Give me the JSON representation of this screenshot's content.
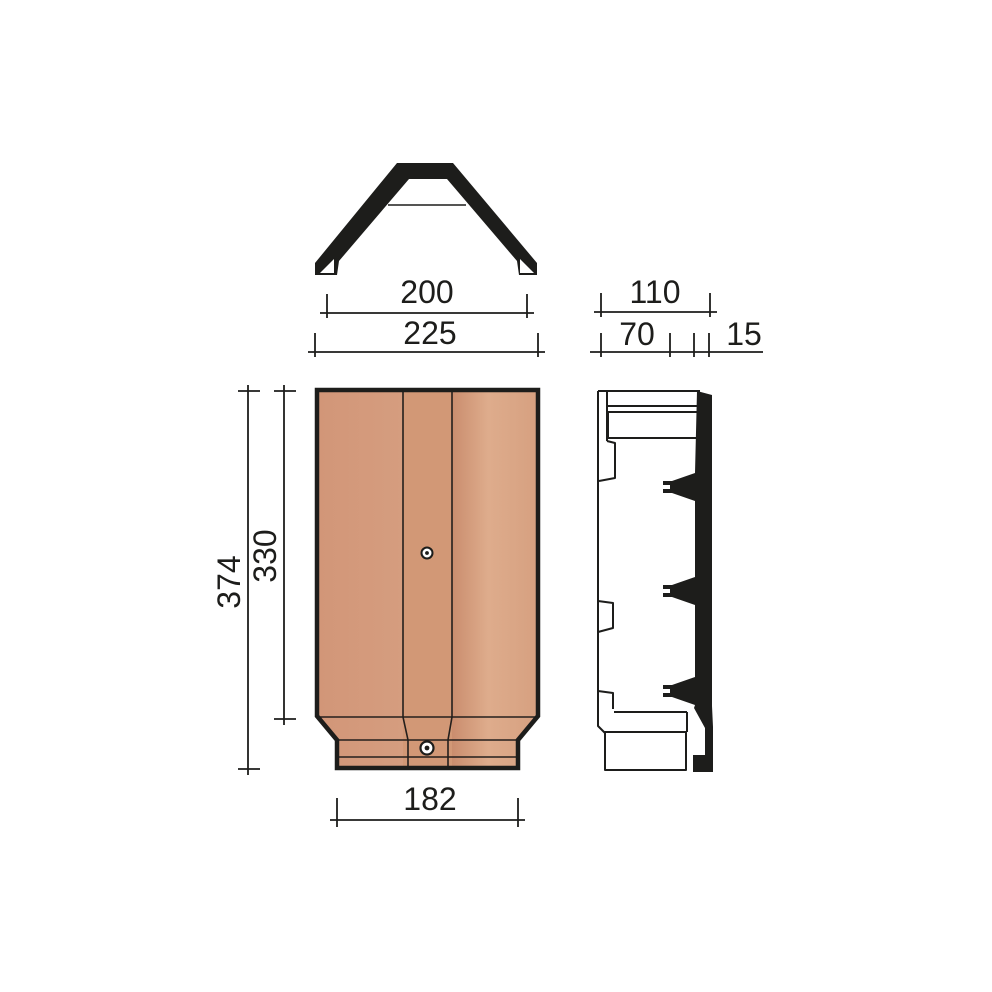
{
  "drawing": {
    "type": "technical-drawing",
    "subject": "ridge-tile-three-view-drawing",
    "views": {
      "front_profile": "angular-ridge-front-profile",
      "plan": "tile-plan-view",
      "side": "tile-side-profile"
    }
  },
  "colors": {
    "ink": "#1d1d1b",
    "background": "#ffffff",
    "tile_left_a": "#d29678",
    "tile_left_b": "#d59d7f",
    "tile_mid": "#d29876",
    "tile_right_a": "#ca8d6e",
    "tile_right_b": "#deac8c",
    "tile_right_c": "#d6a080"
  },
  "dimensions": {
    "inner_width": "200",
    "outer_width": "225",
    "side_depth_total": "110",
    "side_depth_front": "70",
    "side_rib": "15",
    "overall_length": "374",
    "body_length": "330",
    "tail_width": "182"
  }
}
